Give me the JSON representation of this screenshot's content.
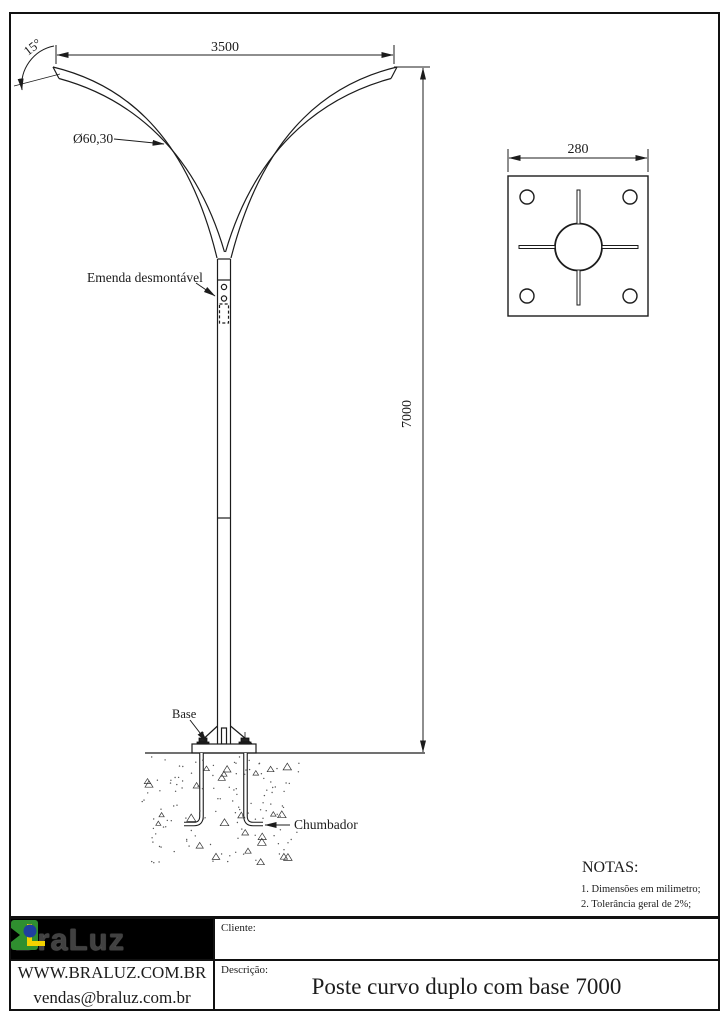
{
  "drawing": {
    "dim_arm_span": "3500",
    "dim_height": "7000",
    "dim_plate": "280",
    "dim_tip_angle": "15°",
    "label_diameter": "Ø60,30",
    "label_joint": "Emenda desmontável",
    "label_base": "Base",
    "label_anchor": "Chumbador"
  },
  "notes": {
    "title": "NOTAS:",
    "items": [
      "1. Dimensões em milimetro;",
      "2. Tolerância geral de 2%;"
    ]
  },
  "title_block": {
    "logo_text": "BraLuz",
    "website": "WWW.BRALUZ.COM.BR",
    "email": "vendas@braluz.com.br",
    "client_label": "Cliente:",
    "client_value": "",
    "description_label": "Descrição:",
    "description_value": "Poste  curvo duplo com base 7000"
  },
  "colors": {
    "line": "#1c1c1c",
    "logo_background": "#000000",
    "logo_letters": "#414141",
    "logo_green": "#2f8f2f",
    "logo_yellow": "#f2d200",
    "logo_blue": "#1f3f9e"
  }
}
